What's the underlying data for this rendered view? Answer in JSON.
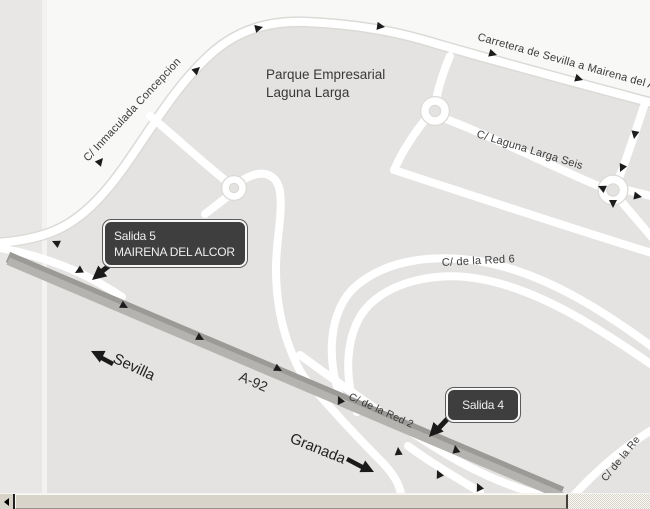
{
  "map": {
    "street_labels": {
      "inmaculada": "C/ Inmaculada Concepcion",
      "carretera": "Carretera de Sevilla a Mairena del A",
      "parque_line1": "Parque Empresarial",
      "parque_line2": "Laguna Larga",
      "laguna_seis": "C/ Laguna Larga Seis",
      "red6": "C/ de la Red 6",
      "red2": "C/ de la Red 2",
      "red_bottom_right": "C/ de la Re",
      "a92": "A-92"
    },
    "destinations": {
      "sevilla": "Sevilla",
      "granada": "Granada"
    },
    "badges": {
      "salida5": {
        "line1": "Salida 5",
        "line2": "MAIRENA DEL ALCOR"
      },
      "salida4": {
        "label": "Salida 4"
      }
    },
    "colors": {
      "block_gray": "#e4e3e1",
      "page_strip": "#e9e7e5",
      "road_white": "#ffffff",
      "road_casing": "#dbdad7",
      "highway_gray": "#aeadaa",
      "badge_background": "#3e3e3e",
      "badge_border": "#f6f6f6",
      "label_text": "#3a3a3a",
      "arrow_black": "#1a1a1a",
      "scrollbar_face": "#d8d4ca"
    }
  },
  "scrollbar": {
    "orientation": "horizontal"
  }
}
